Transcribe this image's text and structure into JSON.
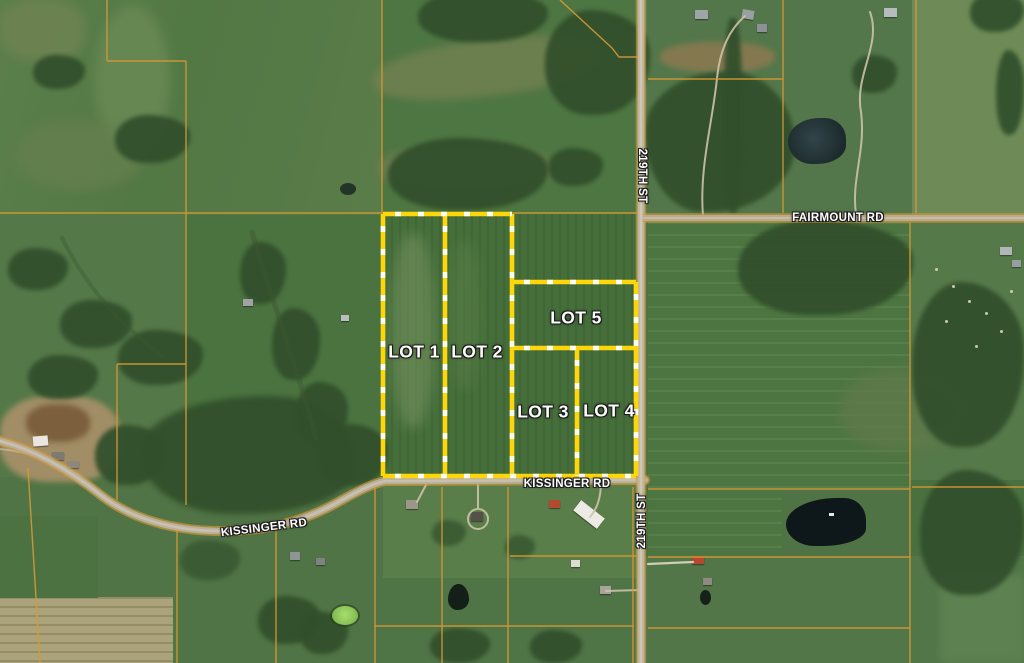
{
  "map": {
    "type": "satellite-parcel-map",
    "lots": [
      {
        "id": "lot-1",
        "label": "LOT 1"
      },
      {
        "id": "lot-2",
        "label": "LOT 2"
      },
      {
        "id": "lot-3",
        "label": "LOT 3"
      },
      {
        "id": "lot-4",
        "label": "LOT 4"
      },
      {
        "id": "lot-5",
        "label": "LOT 5"
      }
    ],
    "road_labels": {
      "street_219_north": "219TH ST",
      "street_219_south": "219TH ST",
      "fairmount": "FAIRMOUNT RD",
      "kissinger_west": "KISSINGER RD",
      "kissinger_east": "KISSINGER RD"
    },
    "colors": {
      "lot_boundary_yellow": "#ffd60a",
      "lot_boundary_dash_white": "#ffffff",
      "parcel_line_orange": "#d79a33",
      "road_fill_tan": "#b8af9c",
      "label_text": "#ffffff"
    }
  }
}
